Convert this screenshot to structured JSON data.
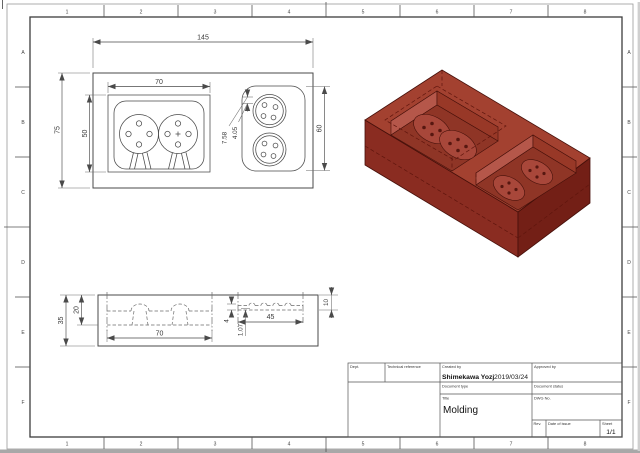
{
  "sheet": {
    "zones_h": [
      "1",
      "2",
      "3",
      "4",
      "5",
      "6",
      "7",
      "8"
    ],
    "zones_v": [
      "A",
      "B",
      "C",
      "D",
      "E",
      "F"
    ]
  },
  "title_block": {
    "dept_label": "Dept.",
    "technical_reference_label": "Technical reference",
    "created_by_label": "Created by",
    "created_by_value": "Shimekawa Yozj",
    "created_date": "2019/03/24",
    "approved_by_label": "Approved by",
    "document_type_label": "Document type",
    "document_status_label": "Document status",
    "title_label": "Title",
    "title_value": "Molding",
    "dwg_no_label": "DWG No.",
    "rev_label": "Rev.",
    "date_of_issue_label": "Date of issue",
    "sheet_label": "Sheet",
    "sheet_value": "1/1"
  },
  "top_view": {
    "overall_width": "145",
    "overall_height": "75",
    "boss_width": "70",
    "boss_height": "50",
    "right_cavity_height": "60",
    "gap_a": "7.58",
    "gap_b": "4.05"
  },
  "side_view": {
    "height": "35",
    "cavity_depth": "20",
    "cavity_width": "70",
    "right_cavity_width": "45",
    "right_cavity_depth": "10",
    "step": "4",
    "land": "1.07"
  },
  "iso": {
    "colors": {
      "top": "#a34130",
      "left": "#8a2c21",
      "right": "#731f16",
      "hole": "#6e1c12",
      "wall_light": "#b5574a",
      "wall_dark": "#983827",
      "floor": "#8f3526",
      "boss": "#a8473a"
    }
  }
}
